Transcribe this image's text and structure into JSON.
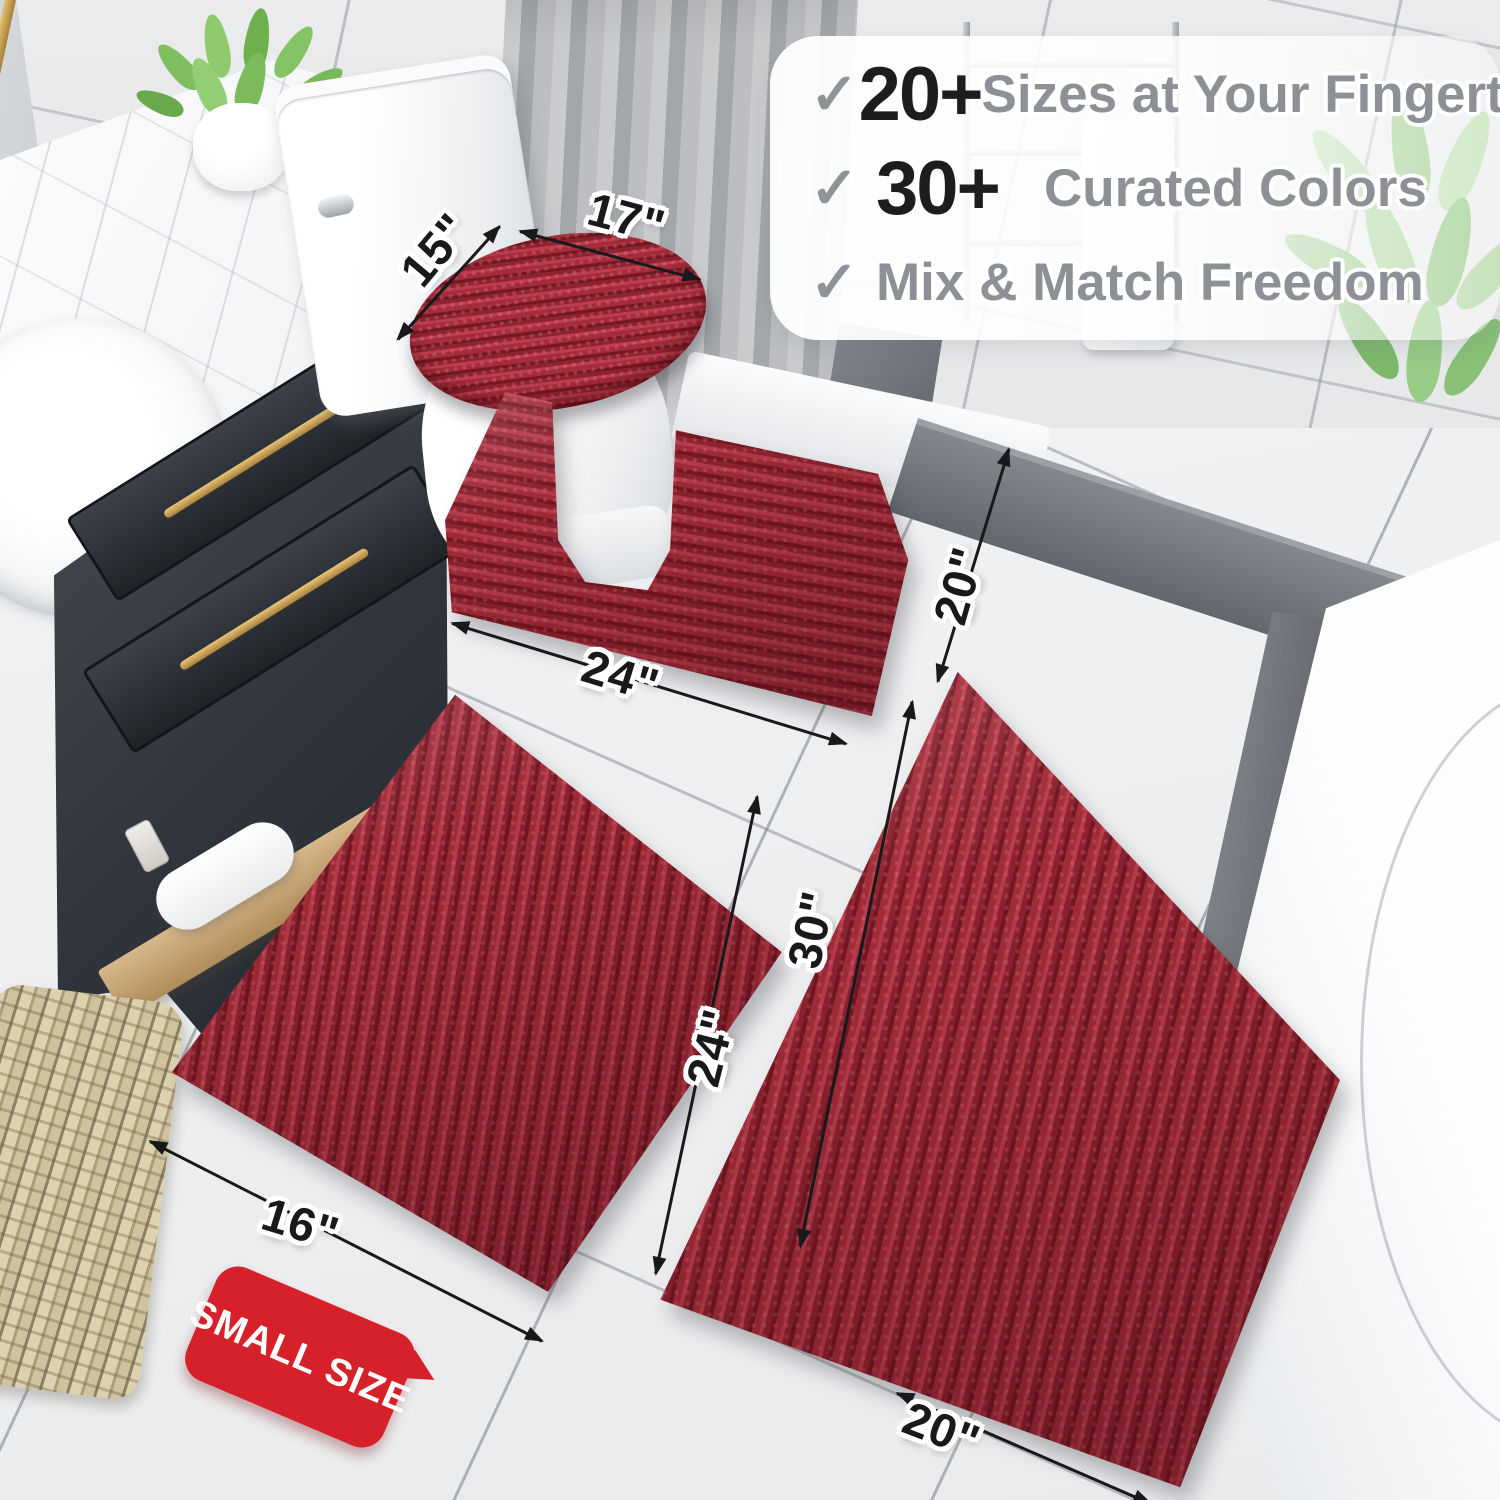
{
  "callout": {
    "items": [
      {
        "check_icon": "✓",
        "number": "20+",
        "label": "Sizes at Your Fingertips"
      },
      {
        "check_icon": "✓",
        "number": "30+",
        "label": "Curated Colors"
      },
      {
        "check_icon": "✓",
        "label": "Mix & Match Freedom"
      }
    ]
  },
  "dimensions": {
    "lid_width": "15\"",
    "lid_length": "17\"",
    "contour_length": "24\"",
    "contour_width": "20\"",
    "small_rug_width": "16\"",
    "small_rug_length": "24\"",
    "large_rug_length": "30\"",
    "large_rug_width": "20\""
  },
  "badge": {
    "label": "SMALL SIZE"
  },
  "colors": {
    "rug_red": "#9E2A37",
    "badge_red": "#D6212B",
    "dimension_text": "#17191B",
    "callout_number": "#1B1D1F",
    "callout_text_gray": "#8D9094",
    "checkmark_gray": "#8F9398"
  }
}
